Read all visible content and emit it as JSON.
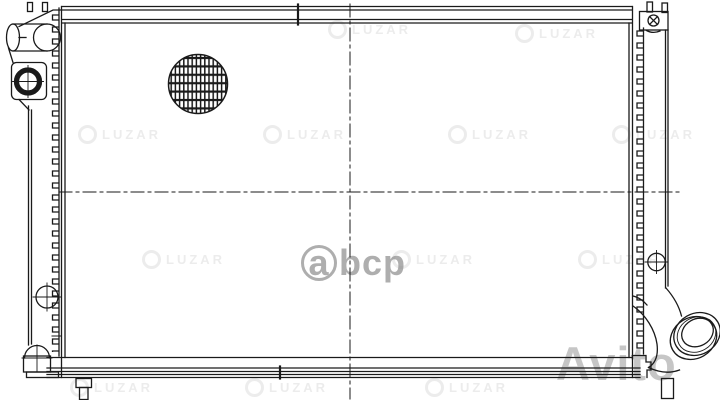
{
  "colors": {
    "line": "#1a1a1a",
    "background": "#ffffff",
    "watermark_gray": "#8f8f8f"
  },
  "watermarks": {
    "abcp": {
      "first_letter": "a",
      "rest": "bcp"
    },
    "luzar": {
      "text": "LUZAR"
    },
    "avito": {
      "text": "Avito"
    }
  }
}
